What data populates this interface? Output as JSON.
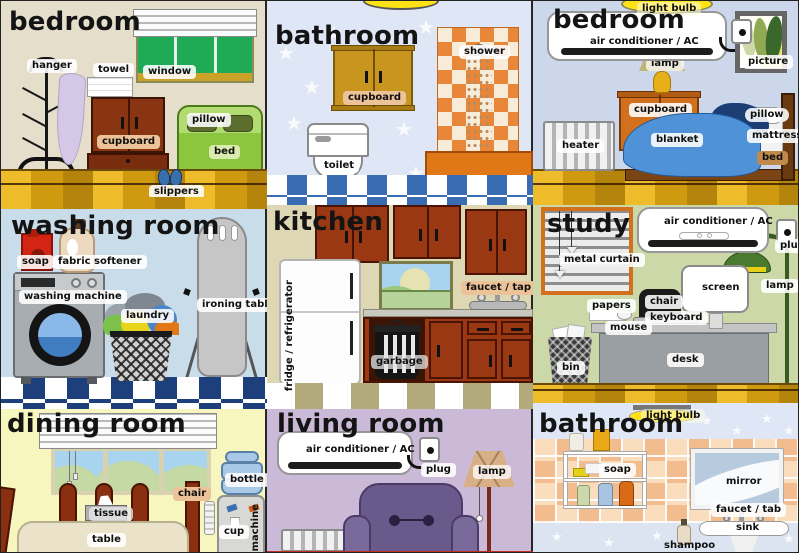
{
  "poster_title": "rooms vocabulary poster",
  "palette": {
    "floor_brick": "#d09a12",
    "checker_blue": "#3a6cb4",
    "checker_navy": "#1d3f7c",
    "checker_khaki": "#b3aa7c",
    "tile_peach": "#f2bc8e",
    "shower_tile_orange": "#e8873a",
    "cabinet_brown": "#993812",
    "tub_orange": "#e07818",
    "bed_green": "#8cc63e",
    "blanket_blue": "#4f92d8",
    "armchair_purple": "#6a5a8c",
    "label_bg": "#ffffff",
    "wall_beige": "#e4decb",
    "wall_star_blue": "#dfe6f5",
    "wall_periwinkle": "#ccd7ec",
    "wall_light_blue": "#c9dcea",
    "wall_khaki": "#ded7b4",
    "wall_green": "#ccd8a8",
    "wall_yellow": "#f6f6be",
    "wall_lavender": "#cbbad7"
  },
  "rooms": {
    "bedroom1": {
      "title": "bedroom",
      "labels": {
        "hanger": "hanger",
        "towel": "towel",
        "window": "window",
        "cupboard": "cupboard",
        "pillow": "pillow",
        "bed": "bed",
        "slippers": "slippers"
      }
    },
    "bathroom1": {
      "title": "bathroom",
      "labels": {
        "cupboard": "cupboard",
        "shower": "shower",
        "toilet": "toilet"
      }
    },
    "bedroom2": {
      "title": "bedroom",
      "labels": {
        "light_bulb": "light bulb",
        "ac": "air conditioner / AC",
        "lamp": "lamp",
        "cupboard": "cupboard",
        "picture": "picture",
        "heater": "heater",
        "blanket": "blanket",
        "pillow": "pillow",
        "mattress": "mattress",
        "bed": "bed"
      }
    },
    "washing": {
      "title": "washing room",
      "labels": {
        "soap": "soap",
        "fabric_softener": "fabric softener",
        "washing_machine": "washing machine",
        "laundry": "laundry",
        "ironing_table": "ironing table"
      }
    },
    "kitchen": {
      "title": "kitchen",
      "labels": {
        "fridge": "fridge / refrigerator",
        "faucet": "faucet / tap",
        "garbage": "garbage"
      }
    },
    "study": {
      "title": "study",
      "labels": {
        "metal_curtain": "metal curtain",
        "ac": "air conditioner / AC",
        "plug": "plug",
        "lamp": "lamp",
        "screen": "screen",
        "chair": "chair",
        "keyboard": "keyboard",
        "mouse": "mouse",
        "papers": "papers",
        "desk": "desk",
        "bin": "bin"
      }
    },
    "dining": {
      "title": "dining room",
      "labels": {
        "bottle": "bottle",
        "chair": "chair",
        "tissue": "tissue",
        "table": "table",
        "cup": "cup",
        "machine": "machine"
      }
    },
    "living": {
      "title": "living room",
      "labels": {
        "ac": "air conditioner / AC",
        "plug": "plug",
        "lamp": "lamp"
      }
    },
    "bathroom2": {
      "title": "bathroom",
      "labels": {
        "light_bulb": "light bulb",
        "soap": "soap",
        "mirror": "mirror",
        "faucet": "faucet / tab",
        "sink": "sink",
        "shampoo": "shampoo"
      }
    }
  }
}
